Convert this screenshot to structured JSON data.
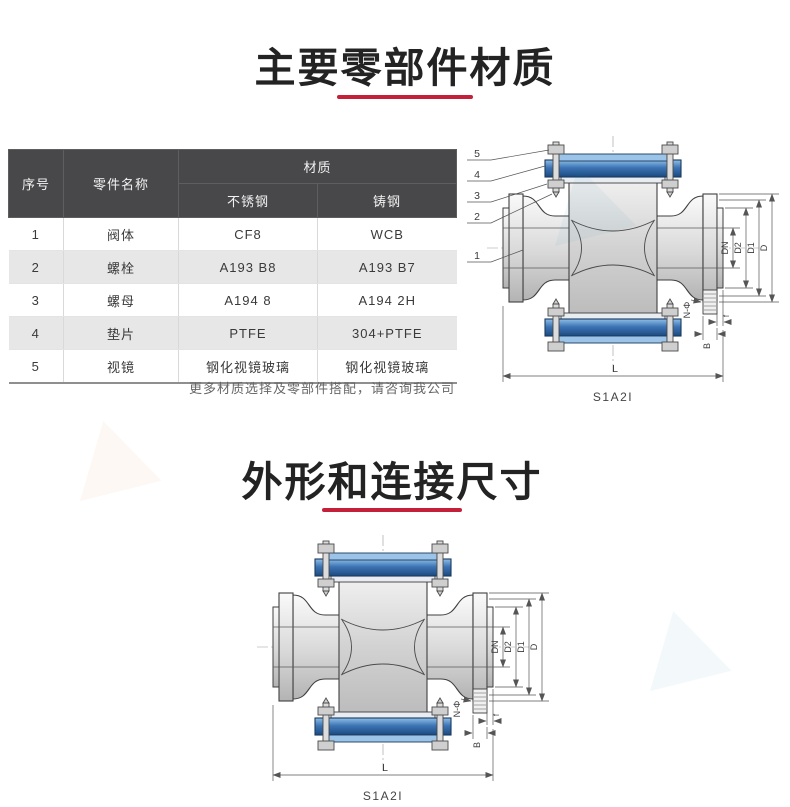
{
  "page": {
    "background": "#ffffff"
  },
  "colors": {
    "accent_red": "#c5203a",
    "table_header_bg": "#48484b",
    "table_row_alt": "#e7e7e7",
    "flange_blue": "#2a5d9c",
    "body_gray": "#cfcfcf"
  },
  "section1": {
    "title": "主要零部件材质",
    "table": {
      "header": {
        "col_no": "序号",
        "col_name": "零件名称",
        "col_material": "材质",
        "sub_stainless": "不锈钢",
        "sub_cast": "铸钢"
      },
      "rows": [
        {
          "no": "1",
          "name": "阀体",
          "stainless": "CF8",
          "cast": "WCB"
        },
        {
          "no": "2",
          "name": "螺栓",
          "stainless": "A193 B8",
          "cast": "A193 B7"
        },
        {
          "no": "3",
          "name": "螺母",
          "stainless": "A194 8",
          "cast": "A194 2H"
        },
        {
          "no": "4",
          "name": "垫片",
          "stainless": "PTFE",
          "cast": "304+PTFE"
        },
        {
          "no": "5",
          "name": "视镜",
          "stainless": "钢化视镜玻璃",
          "cast": "钢化视镜玻璃"
        }
      ],
      "note": "更多材质选择及零部件搭配，请咨询我公司"
    },
    "diagram": {
      "caption": "S1A2I",
      "callouts": [
        "5",
        "4",
        "3",
        "2",
        "1"
      ]
    }
  },
  "section2": {
    "title": "外形和连接尺寸",
    "diagram": {
      "caption": "S1A2I"
    }
  },
  "valve_labels": {
    "dn": "DN",
    "d2": "D2",
    "d1": "D1",
    "d": "D",
    "n_phi": "N-Φ",
    "f": "f",
    "b": "B",
    "l": "L"
  }
}
